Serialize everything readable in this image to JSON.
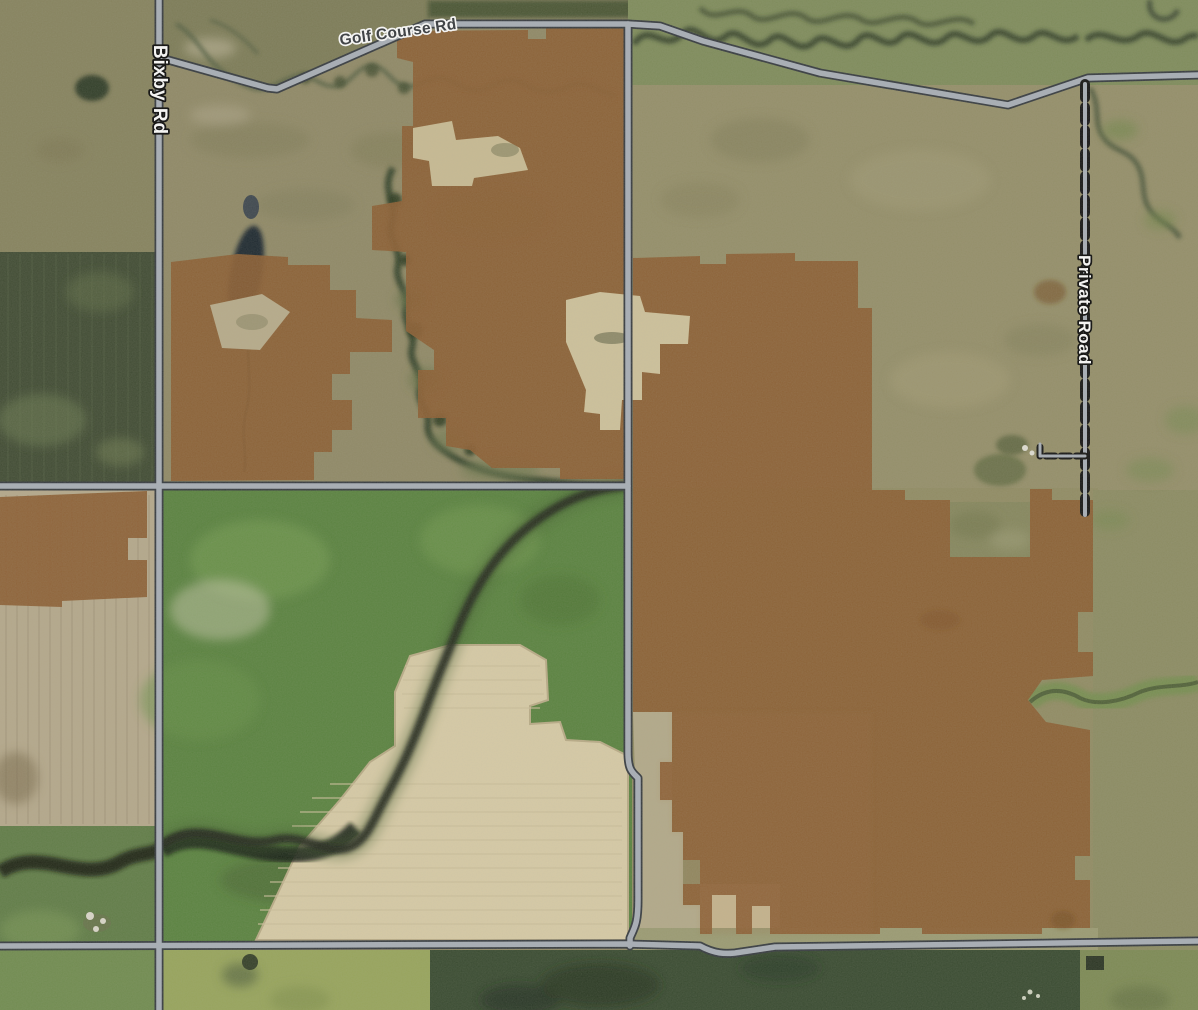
{
  "map": {
    "kind_note": "satellite imagery with parcel overlay",
    "labels": {
      "golf_course_rd": "Golf Course Rd",
      "bixby_rd": "Bixby Rd",
      "private_road": "Private Road"
    },
    "colors": {
      "parcel_overlay": "#8a5a2c",
      "road_fill": "#a7aeb7",
      "road_casing": "#2f343a",
      "dashed_road_casing": "#0c0c0c",
      "major_label_fill": "#2e3237",
      "major_label_halo": "#ffffff",
      "minor_label_fill": "#ffffff",
      "minor_label_halo": "#000000"
    }
  }
}
